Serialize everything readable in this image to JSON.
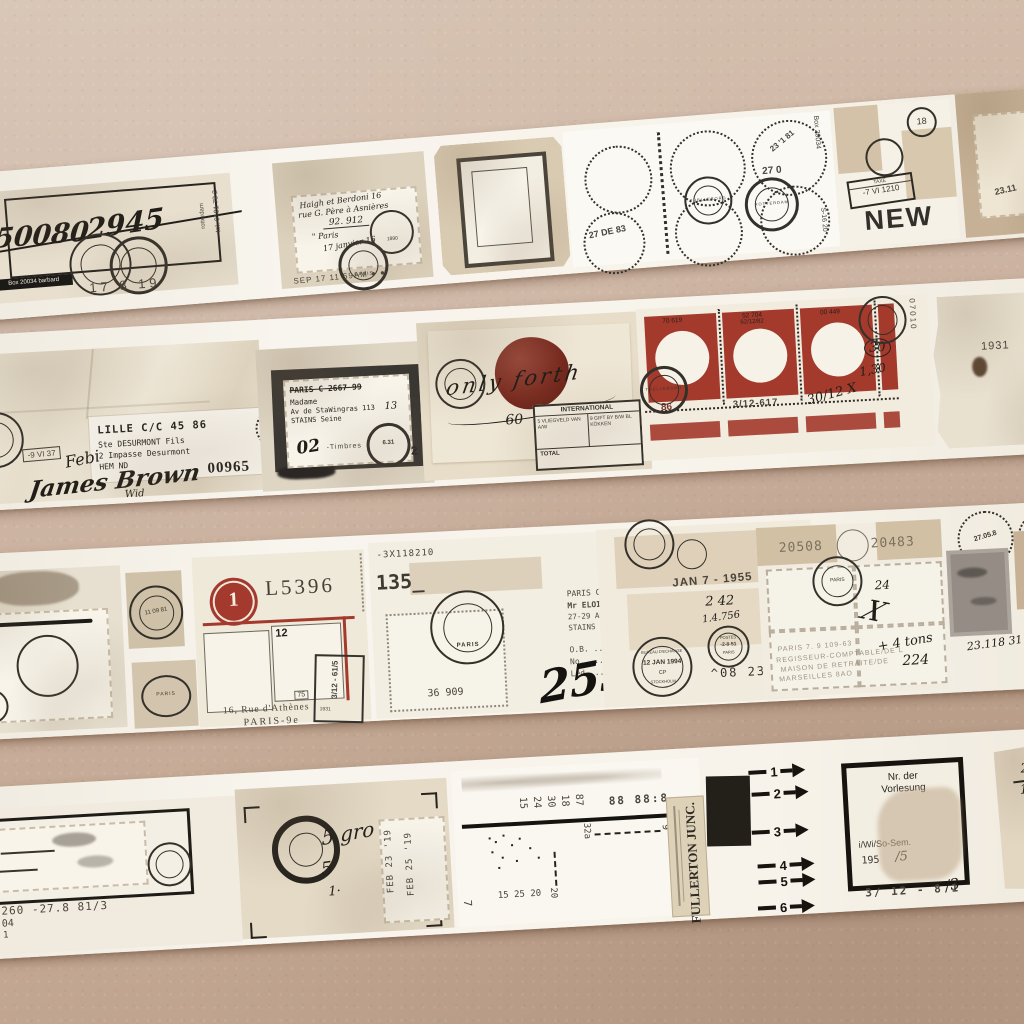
{
  "wall_color": "#c8ae9c",
  "tape_color": "#f6f2ea",
  "accent_red": "#a33a2c",
  "s1": {
    "code_left": "50080",
    "code_right": "2945",
    "chip_box": "Box 20034",
    "chip_name": "barbard",
    "tel_vert": "tel. 0101 78 2",
    "rotterdam_vert": "rotterdam",
    "num17819": "17 8 19",
    "stamp_lines": [
      "Haigh et Berdoni 16",
      "rue G. Père à Asnières",
      "92. 912",
      "\" Paris",
      "17 janvier 16"
    ],
    "year1890": "1890",
    "paris_ring": "PARIS",
    "sep_stamp": "SEP 17 11 59AM ● ●",
    "date_2783": "27 DE 83",
    "date_270": "27 0",
    "date_23181": "23 '1 81",
    "ring_trelleborg": "TRELLEBORG",
    "ring_rotterdam": "ROTTERDAM",
    "box_vert": "Box 20034",
    "s1620_vert": "S-16 20",
    "n18": "18",
    "taxe": "TAXE",
    "tax_date": "-7 VI 1210",
    "new_word": "NEW",
    "mark_2311": "23.11"
  },
  "s2": {
    "label_lines": [
      "LILLE C/C  45 86",
      "Ste DESURMONT Fils",
      "2 Impasse Desurmont",
      "HEM ND"
    ],
    "febi": "Febi",
    "signature": "James Brown",
    "sig_sub": "Wid",
    "num00965": "00965",
    "box_stamp": "-9 VI 37",
    "dark_lines": [
      "PARIS C 2667 99",
      "Madame",
      "Av de StaWingras 113",
      "STAINS Seine"
    ],
    "n13": "13",
    "hand02": "02",
    "timbres": "-Timbres",
    "ring_631": "6.31",
    "n2": "2",
    "wax_script": "only forth",
    "hand60": "60",
    "intl": "INTERNATIONAL",
    "cell_a": "5 VLIEGVELD VAN A/W",
    "cell_b": "9 GIFT BY B/W BL KÖKKEN",
    "total": "TOTAL",
    "red_n1": "70 619",
    "red_n2": "52 704",
    "red_n2b": "62/12/82",
    "red_n3": "00 449",
    "below_86": "86",
    "below_312617": "3/12-617",
    "hand_3012": "30/12 X",
    "hand_30": "30",
    "hand_130": "1,30",
    "vert_07010": "07010",
    "ring_trelleborg": "TRELLEBORG",
    "n1931": "1931"
  },
  "s3": {
    "vert_2219": "22 19",
    "ring_date": "11 09 81",
    "ring_paris": "PARIS",
    "badge1": "1",
    "serial": "L5396",
    "n12": "12",
    "n75": "75",
    "addr1": "16, Rue d'Athènes",
    "addr2": "PARIS-9e",
    "boxstamp": "3/12 - 61/5",
    "small1931": "1931",
    "code": "-3X118210",
    "n135": "135_",
    "n36909": "36 909",
    "typed_lines": [
      "PARIS C    -12•540-58",
      "Mr ELOI Paul",
      "27-29 Av.Aristide Briand",
      "STAINS Seine"
    ],
    "form_ob": "O.B. ..........",
    "form_no": "No. ......",
    "hand469": "469",
    "form_led": "Led. ..........",
    "hand253": "253",
    "jan1955": "JAN 7 - 1955",
    "hand242": "2 42",
    "hand14756": "1.4.756",
    "ringb_l1": "BUREAU D'ECHANGE",
    "ringb_l2": "12 JAN 1994",
    "ringb_l3": "CP",
    "ringb_l4": "STOCKHOLM",
    "ringp_l1": "POSTES",
    "ringp_l2": "-2-8-51",
    "ringp_l3": "PARIS",
    "n08232": "^08 232",
    "n20508": "20508",
    "n20483": "20483",
    "hand24": "24",
    "handx": "X",
    "hand4tons": "+ 4 tons",
    "hand224": "224",
    "faint_lines": [
      "PARIS 7.   9 109-63",
      "REGISSEUR-COMPTABLE/DE L",
      "MAISON DE RETRAITE/DE",
      "MARSEILLES 8AO"
    ],
    "d270585": "27.05.8",
    "d110184": "11.01.84",
    "hand23118": "23.118 31"
  },
  "s4": {
    "ex": "EX",
    "box260": "Box 260  -27.8 81/3",
    "n530104": "5-301 04",
    "a1": "A 1",
    "hand5gro": "5 gro",
    "hand5": "5",
    "hand1": "1·",
    "feb23": "FEB 23 '19",
    "feb25": "FEB 25 '19",
    "rot_nums": [
      "15",
      "24",
      "30",
      "18",
      "87"
    ],
    "rot_8888": "88 88:8",
    "n32a": "32a",
    "n9": "9",
    "n20": "20",
    "n152520": "15 25 20",
    "n7": "7",
    "fullerton": "FULLERTON JUNC.",
    "arrows": [
      "1",
      "2",
      "3",
      "4",
      "5",
      "6"
    ],
    "vor_l1": "Nr. der",
    "vor_l2": "Vorlesung",
    "vor_l3": "i/Wi/So-Sem.",
    "vor_l4": "195",
    "vor_l5": "/5",
    "under_box": "3/ 12 - 8 1",
    "under_hand": "/3",
    "frac_a": "13:",
    "frac_b": "2,",
    "frac_c": "16",
    "iw": "i/W"
  }
}
